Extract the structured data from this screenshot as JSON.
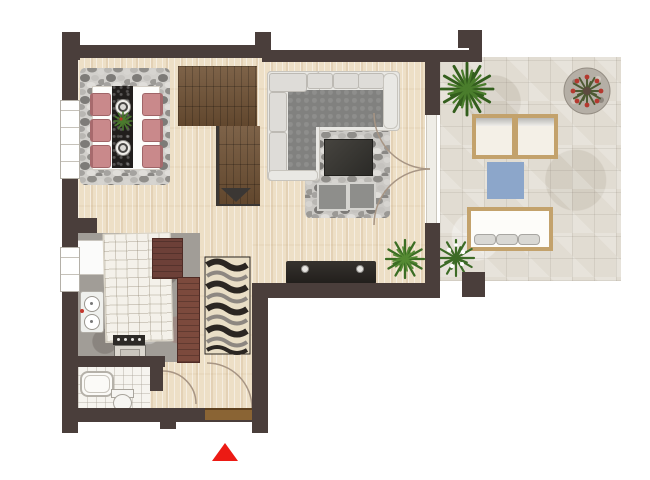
{
  "scene": {
    "kind": "apartment floor plan, top-down 2D render with terrace",
    "entrance_marker": {
      "icon": "red-triangle-up",
      "color": "#ec1a14"
    },
    "palette": {
      "wall": "#4a3e3b",
      "wood_floor": "#eddfc6",
      "stair_wood": "#6f5134",
      "terrace_stone": "#e1dcd2",
      "kitchen_stone": "#a19d97",
      "bath_tile": "#f6f4ef",
      "chair_pink": "#c9898b",
      "sofa_seat_grey": "#81817f",
      "outdoor_frame_wood": "#c3a26c",
      "blue_outdoor_rug": "#8ca6ca",
      "entrance_door_wood": "#8a6434",
      "console_dark": "#211e1b",
      "plant_green": "#3d6b2a"
    },
    "windows": {
      "left_wall_count": 2
    },
    "doors": {
      "entrance": 1,
      "french_doors_to_terrace": 2,
      "interior_swing": 2
    },
    "rooms": [
      {
        "name": "dining-area",
        "floor": "wood",
        "furniture": [
          "pebble-rug",
          "dining-table",
          "black-table-runner",
          "plate",
          "plate",
          "centerpiece-plant",
          "pink-chair-x6"
        ]
      },
      {
        "name": "living-room",
        "floor": "wood",
        "furniture": [
          "l-shaped-sofa",
          "pebble-rug",
          "coffee-table",
          "pouf",
          "pouf",
          "media-console",
          "console-lamp",
          "console-lamp",
          "potted-plant"
        ]
      },
      {
        "name": "kitchen",
        "floor": "stone",
        "furniture": [
          "fridge",
          "tiled-island-counter",
          "upper-cabinet",
          "tall-cabinet",
          "double-basin-sink",
          "oven-with-cooktop"
        ]
      },
      {
        "name": "bathroom",
        "floor": "tile",
        "furniture": [
          "bathtub",
          "toilet"
        ]
      },
      {
        "name": "hallway",
        "floor": "wood",
        "furniture": [
          "wavy-runner-rug",
          "entrance-door"
        ]
      },
      {
        "name": "staircase",
        "floor": "stair-wood",
        "furniture": [
          "stairs-with-down-arrow"
        ]
      },
      {
        "name": "terrace",
        "floor": "stone-pavers",
        "furniture": [
          "palm-plant",
          "round-flower-planter",
          "wood-armchair",
          "wood-armchair",
          "blue-outdoor-rug",
          "garden-bench-3-cushions",
          "flowering-plant",
          "corner-pillar"
        ]
      }
    ]
  }
}
